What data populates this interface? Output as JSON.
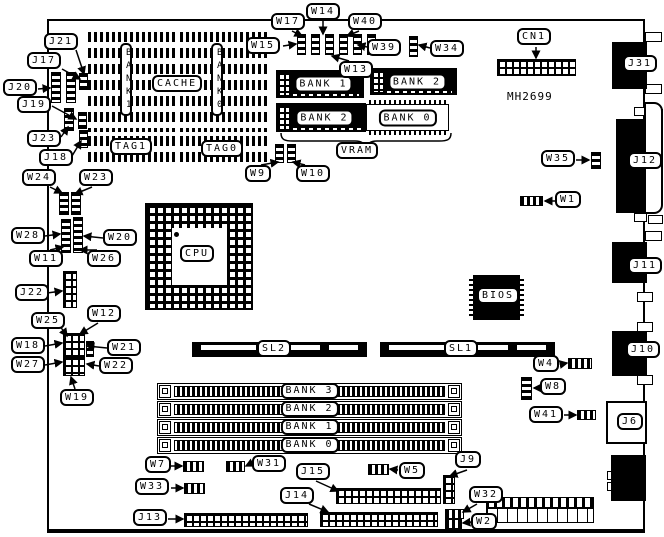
{
  "title": "Motherboard jumper and connector location diagram",
  "part_number": "MH2699",
  "colors": {
    "ink": "#000000",
    "paper": "#ffffff"
  },
  "cache": {
    "title": "CACHE",
    "array_left_label": "BANK 1",
    "array_right_label": "BANK 0",
    "tag_left": "TAG1",
    "tag_right": "TAG0"
  },
  "vram": {
    "title": "VRAM",
    "banks": [
      "BANK 1",
      "BANK 2",
      "BANK 2",
      "BANK 0"
    ]
  },
  "simm": {
    "banks": [
      "BANK 3",
      "BANK 2",
      "BANK 1",
      "BANK 0"
    ]
  },
  "chips": {
    "cpu": "CPU",
    "bios": "BIOS"
  },
  "slots": {
    "sl2": "SL2",
    "sl1": "SL1"
  },
  "jumpers": {
    "w1": "W1",
    "w2": "W2",
    "w4": "W4",
    "w5": "W5",
    "w7": "W7",
    "w8": "W8",
    "w9": "W9",
    "w10": "W10",
    "w11": "W11",
    "w12": "W12",
    "w13": "W13",
    "w14": "W14",
    "w15": "W15",
    "w17": "W17",
    "w18": "W18",
    "w19": "W19",
    "w20": "W20",
    "w21": "W21",
    "w22": "W22",
    "w23": "W23",
    "w24": "W24",
    "w25": "W25",
    "w26": "W26",
    "w27": "W27",
    "w28": "W28",
    "w31": "W31",
    "w32": "W32",
    "w33": "W33",
    "w34": "W34",
    "w35": "W35",
    "w39": "W39",
    "w40": "W40",
    "w41": "W41"
  },
  "connectors": {
    "cn1": "CN1",
    "j6": "J6",
    "j9": "J9",
    "j10": "J10",
    "j11": "J11",
    "j12": "J12",
    "j13": "J13",
    "j14": "J14",
    "j15": "J15",
    "j17": "J17",
    "j18": "J18",
    "j19": "J19",
    "j20": "J20",
    "j21": "J21",
    "j22": "J22",
    "j23": "J23",
    "j31": "J31"
  }
}
